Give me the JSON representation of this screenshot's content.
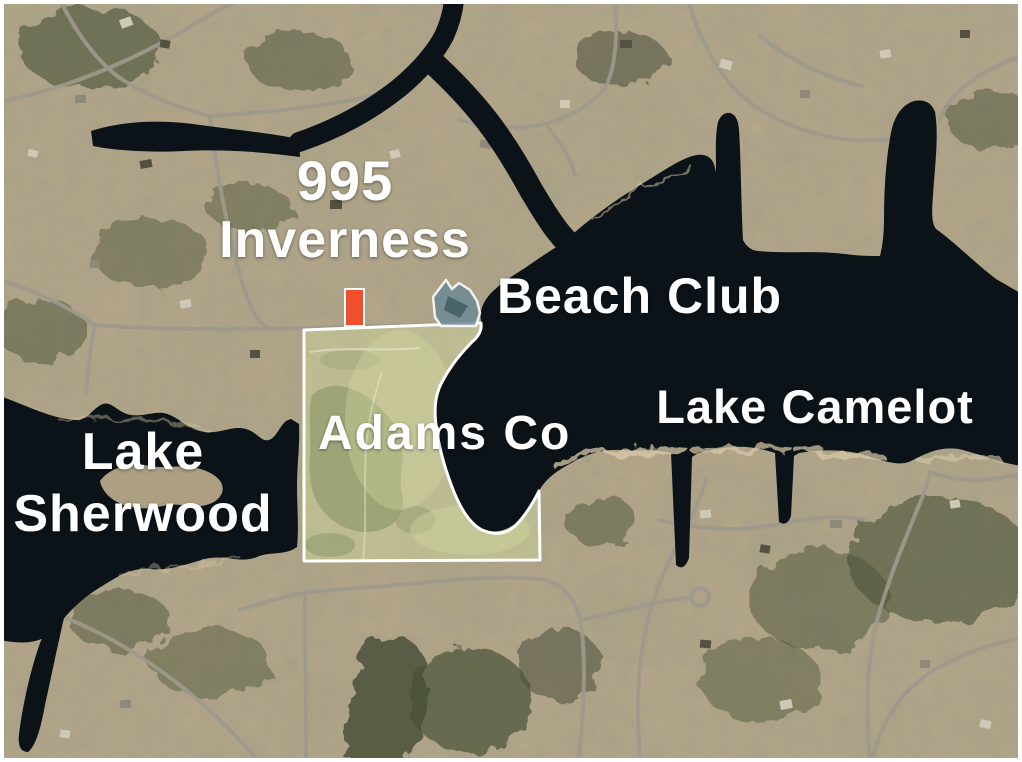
{
  "map": {
    "labels": {
      "property_number": "995",
      "property_street": "Inverness",
      "beach_club": "Beach Club",
      "lake_east": "Lake Camelot",
      "lake_west_line1": "Lake",
      "lake_west_line2": "Sherwood",
      "parcel_owner": "Adams Co"
    },
    "colors": {
      "water": "#0c1318",
      "land": "#b6a78a",
      "forest": "#4a5138",
      "road": "#9f998d",
      "beach_sand": "#d9caa7",
      "parcel_fill": "#cdd39b",
      "parcel_outline": "#ffffff",
      "highlight_marker": "#f04f2d",
      "beach_club_fill": "#6d8b95",
      "label_text": "#ffffff"
    }
  }
}
